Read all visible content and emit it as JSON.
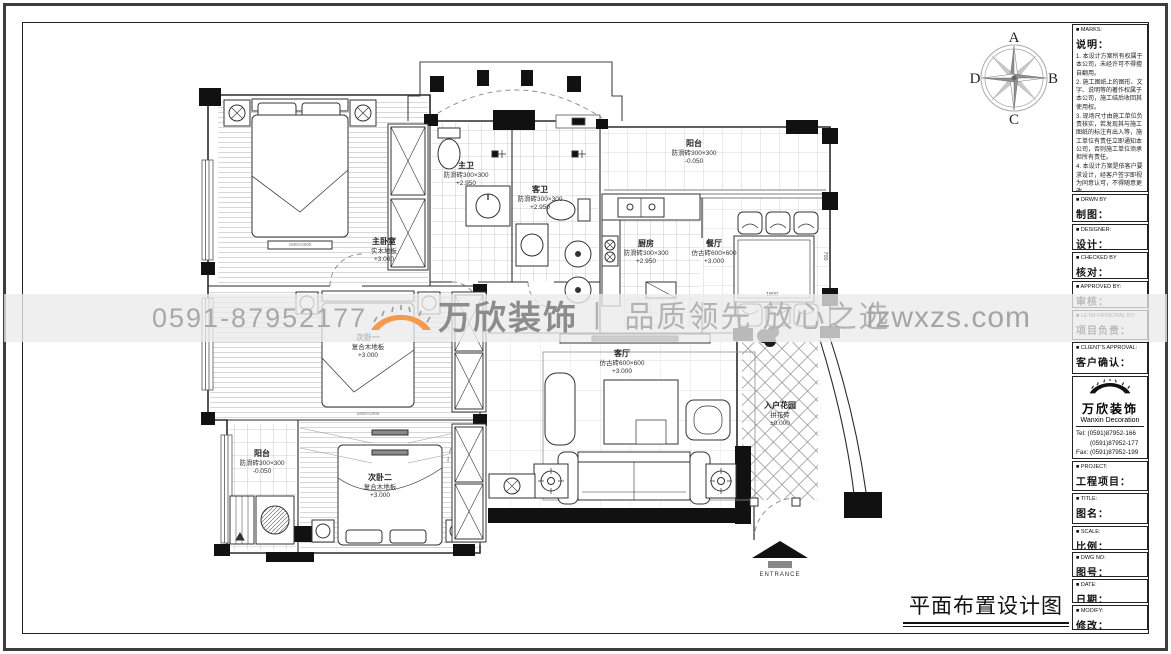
{
  "drawing_title": "平面布置设计图",
  "compass": {
    "top": "A",
    "right": "B",
    "bottom": "C",
    "left": "D"
  },
  "watermark": {
    "phone": "0591-87952177",
    "brand": "万欣装饰",
    "slogan": "丨 品质领先  放心之选",
    "site": "fzwxzs.com",
    "accent_orange": "#F49A4E",
    "text_gray": "#a8a8a8"
  },
  "plan": {
    "entrance_label": "ENTRANCE",
    "dims": {
      "dining_table": "1800",
      "right_wall": "700",
      "bed_master": "1800×2000",
      "bed_second": "1800×2000"
    },
    "rooms": [
      {
        "name": "主卧室",
        "floor": "实木地板",
        "level": "+3.000"
      },
      {
        "name": "次卧一",
        "floor": "复合木地板",
        "level": "+3.000"
      },
      {
        "name": "次卧二",
        "floor": "复合木地板",
        "level": "+3.000"
      },
      {
        "name": "主卫",
        "floor": "防滑砖300×300",
        "level": "+2.950"
      },
      {
        "name": "客卫",
        "floor": "防滑砖300×300",
        "level": "+2.950"
      },
      {
        "name": "阳台",
        "floor": "防滑砖300×300",
        "level": "-0.050"
      },
      {
        "name": "厨房",
        "floor": "防滑砖300×300",
        "level": "+2.950"
      },
      {
        "name": "餐厅",
        "floor": "仿古砖600×600",
        "level": "+3.000"
      },
      {
        "name": "客厅",
        "floor": "仿古砖600×600",
        "level": "+3.000"
      },
      {
        "name": "入户花园",
        "floor": "拼花砖",
        "level": "±0.000"
      },
      {
        "name": "阳台",
        "floor": "防滑砖300×300",
        "level": "-0.050"
      }
    ]
  },
  "title_block": {
    "marks": {
      "en": "■ MARKS:",
      "zh": "说明："
    },
    "notes": [
      "1. 本设计方案所有权属于本公司，未经许可不得擅自翻用。",
      "2. 施工图纸上的图形、文字、说明等的著作权属于本公司，施工结后收回其使用权。",
      "3. 现场尺寸由施工单位负责核实，若发现其与施工图纸的标注有出入等，施工单位有责任立即通知本公司，否则施工单位须承担所有责任。",
      "4. 本设计方案是依客户要求设计，经客户签字即视为同意认可，不得随意更改。"
    ],
    "fields": [
      {
        "en": "■ DRWN BY",
        "zh": "制图："
      },
      {
        "en": "■ DESIGNER:",
        "zh": "设计："
      },
      {
        "en": "■ CHECKED BY",
        "zh": "核对："
      },
      {
        "en": "■ APPROVED BY:",
        "zh": "审核："
      },
      {
        "en": "■ LETM PRINCIPAL BY:",
        "zh": "项目负责："
      },
      {
        "en": "■ CLIENT'S APPROVAL:",
        "zh": "客户确认："
      }
    ],
    "company": {
      "name": "万欣装饰",
      "name_en": "Wanxin Decoration",
      "tel1": "Tel: (0591)87952-166",
      "tel2": "(0591)87952-177",
      "fax": "Fax: (0591)87952-199",
      "web": "Web: WWW.fzwxzs.com"
    },
    "fields2": [
      {
        "en": "■ PROJECT:",
        "zh": "工程项目："
      },
      {
        "en": "■ TITLE:",
        "zh": "图名："
      },
      {
        "en": "■ SCALE:",
        "zh": "比例："
      },
      {
        "en": "■ DWG NO:",
        "zh": "图号："
      },
      {
        "en": "■ DATE:",
        "zh": "日期："
      },
      {
        "en": "■ MODIFY:",
        "zh": "修改："
      }
    ]
  }
}
